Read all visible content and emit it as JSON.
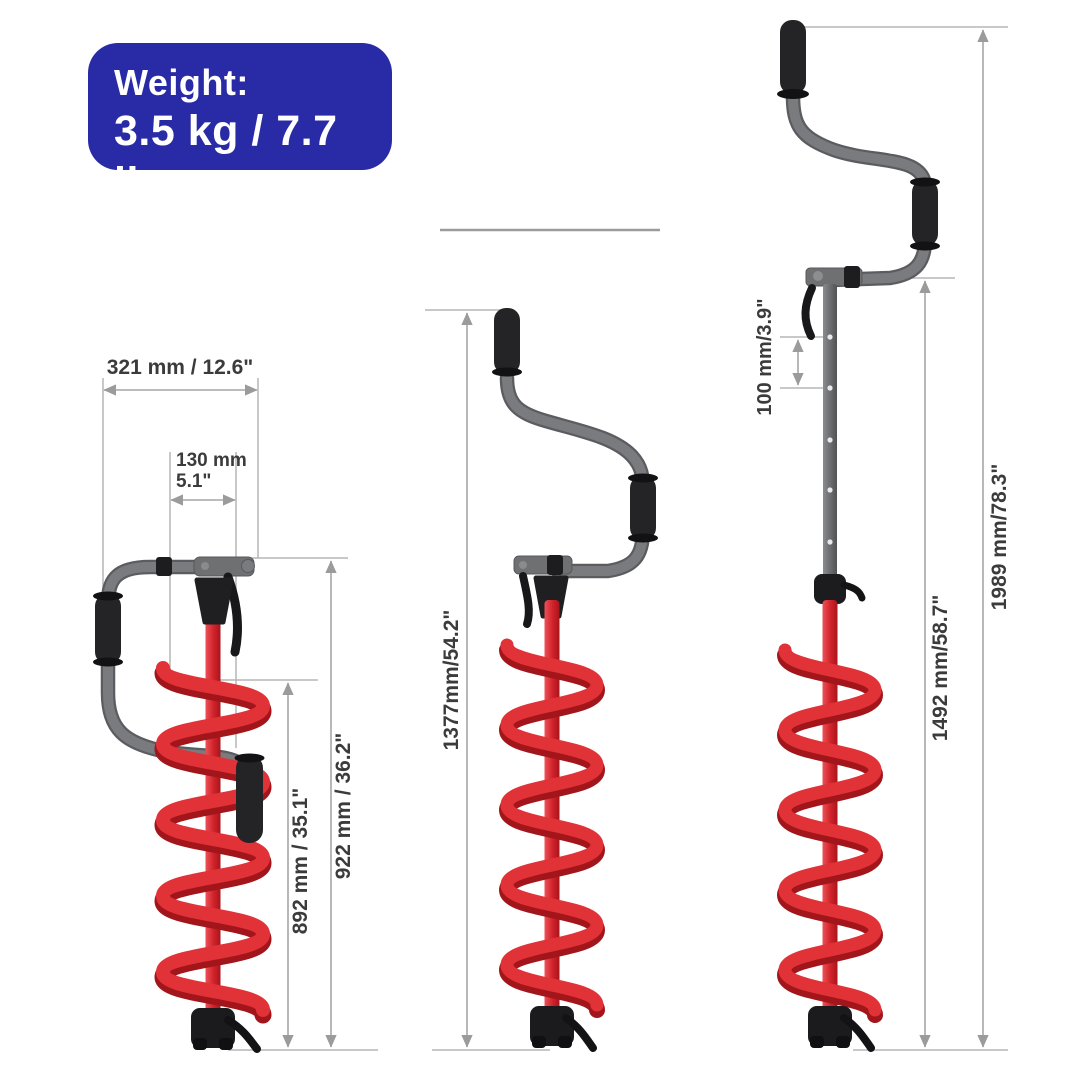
{
  "badge": {
    "title": "Weight:",
    "value": "3.5 kg / 7.7 lb",
    "bg_color": "#292ba6",
    "text_color": "#ffffff"
  },
  "dimensions": {
    "collapsed": {
      "crank_width": "321 mm / 12.6\"",
      "blade_width_mm": "130 mm",
      "blade_width_in": "5.1\"",
      "auger_height": "892 mm / 35.1\"",
      "overall_height": "922 mm / 36.2\""
    },
    "mid": {
      "overall_height": "1377mm/54.2\""
    },
    "extended": {
      "hole_spacing": "100 mm/3.9\"",
      "shaft_height": "1492 mm/58.7\"",
      "overall_height": "1989 mm/78.3\""
    }
  },
  "colors": {
    "accent_blue": "#292ba6",
    "auger_red": "#d9252c",
    "auger_red_dark": "#a2151b",
    "metal_gray": "#77787b",
    "grip_black": "#1c1c1e",
    "dimension_line_gray": "#a6a6a6",
    "label_text": "#3b3b3b"
  }
}
